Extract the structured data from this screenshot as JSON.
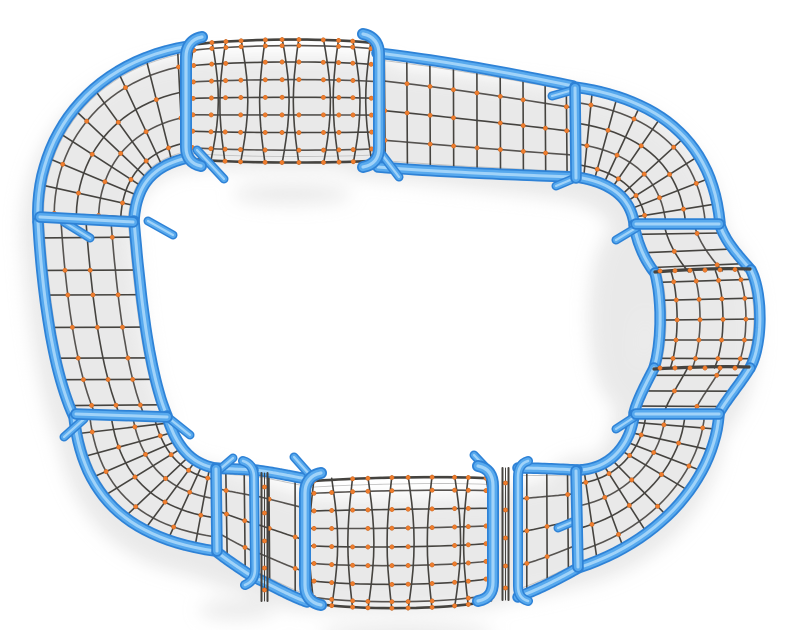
{
  "scene": {
    "title": "Rope climbing loop structure - top view render",
    "description": "Top-down 3D product render of a closed-loop playground climbing net: a rounded rectangular track of rope netting stretched between light-blue steel tubes, with orange ball connectors at rope crossings, a rope tunnel at the top and bottom, a rounded bulge on the right side, fan-shaped corner nets, and soft gray shadows on a white background.",
    "background": "#ffffff"
  },
  "colors": {
    "tube_base": "#2e82d6",
    "tube_mid": "#57a9ee",
    "tube_gloss": "#a9d7fa",
    "rope": "#45433f",
    "rope_light": "#8a8a8a",
    "cable": "#c2c2c2",
    "connector": "#ef7d2e",
    "connector_edge": "#c4611a",
    "shadow": "#d4d4d4"
  },
  "structure": {
    "parts": [
      "top-left corner fan net",
      "top rope tunnel",
      "top-right straight net",
      "top-right corner fan net",
      "right side barrel bulge net",
      "bottom-right corner fan net",
      "bottom rope tunnel",
      "bottom-left corner fan net",
      "left straight net"
    ],
    "frame_material": "blue steel tube",
    "net_material": "dark rope with orange ball clamps"
  }
}
